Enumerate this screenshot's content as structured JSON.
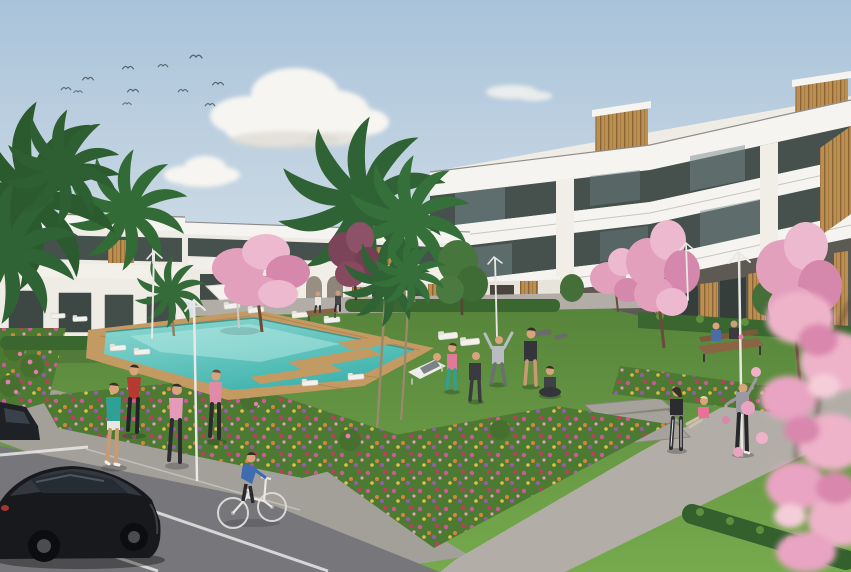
{
  "scene": {
    "kind": "architectural-render",
    "setting": "Modern white residential complex with communal swimming pool, gardens, exercise areas and street parking",
    "time_of_day": "daytime, clear sky",
    "sky": {
      "bird_count": 11,
      "cloud_count": 3
    },
    "buildings": {
      "right_block": {
        "floors": 3,
        "style": "white apartment block, glass balconies, timber cladding accents"
      },
      "left_row": {
        "floors": 2,
        "style": "white townhouse terraces with timber slat doors and roof decks"
      },
      "courtyard": {
        "style": "white courtyard walls with arches and timber slats"
      }
    },
    "amenities": [
      "swimming pool",
      "timber pool deck",
      "sun loungers",
      "white parasol",
      "garden benches",
      "street lamps",
      "stone steps"
    ],
    "vegetation": [
      "palm trees",
      "pink cherry-blossom trees",
      "purple-leaf tree",
      "green trees",
      "flower beds",
      "hedges",
      "lawns"
    ],
    "people": [
      {
        "activity": "walking",
        "top_color": "red"
      },
      {
        "activity": "walking",
        "top_color": "pink"
      },
      {
        "activity": "jogging",
        "top_color": "teal"
      },
      {
        "activity": "jogging",
        "top_color": "pink"
      },
      {
        "activity": "cycling",
        "top_color": "blue"
      },
      {
        "activity": "lounging on deck chair",
        "top_color": "grey"
      },
      {
        "activity": "group exercise",
        "top_color": "pink / teal leggings"
      },
      {
        "activity": "group exercise",
        "top_color": "dark"
      },
      {
        "activity": "stretching arms up",
        "top_color": "light grey"
      },
      {
        "activity": "exercise",
        "top_color": "black with shorts"
      },
      {
        "activity": "seated cross-legged",
        "top_color": "dark"
      },
      {
        "activity": "standing",
        "top_color": "black crop top"
      },
      {
        "activity": "seated on step",
        "top_color": "pink"
      },
      {
        "activity": "stretching",
        "top_color": "grey hoodie"
      },
      {
        "activity": "sitting on bench",
        "top_color": "blue"
      },
      {
        "activity": "sitting on bench",
        "top_color": "dark"
      },
      {
        "activity": "strolling by pool",
        "top_color": "white"
      },
      {
        "activity": "strolling by pool",
        "top_color": "dark"
      }
    ],
    "vehicles": [
      {
        "name": "black-hatchback",
        "color": "#17191c"
      },
      {
        "name": "parked-car-edge",
        "color": "#1e2126"
      }
    ]
  },
  "palette": {
    "sky_top": "#a9c3da",
    "sky_horizon": "#dde5ea",
    "cloud": "#f7f5f1",
    "cloud_shade": "#dcd8d2",
    "bird": "#55636e",
    "bldg_white": "#f6f4f0",
    "bldg_wall": "#efece6",
    "bldg_shade": "#e6e2db",
    "glass": "#46514d",
    "glass_light": "#7e9294",
    "wood": "#bb8f52",
    "wood_dark": "#8a6434",
    "lawn_far": "#55833a",
    "lawn_near": "#76aa4d",
    "hedge": "#3a6630",
    "path": "#b2aea7",
    "sidewalk": "#a39f99",
    "asphalt": "#77777b",
    "road_line": "#e8e8e6",
    "deck": "#c49a63",
    "pool_light": "#8fd9d2",
    "pool_deep": "#3fb3ad",
    "flower_base": "#4c7a33",
    "blossom": "#e3a0bd",
    "blossom_light": "#ecb9cf",
    "blossom_deep": "#d687ac",
    "purple_tree": "#7c4458",
    "palm": "#2f6234",
    "trunk": "#8f7f63",
    "lamp": "#e9e8e4",
    "bench_wood": "#8a6543",
    "car_black": "#17191c",
    "skin": "#d9a47c"
  }
}
